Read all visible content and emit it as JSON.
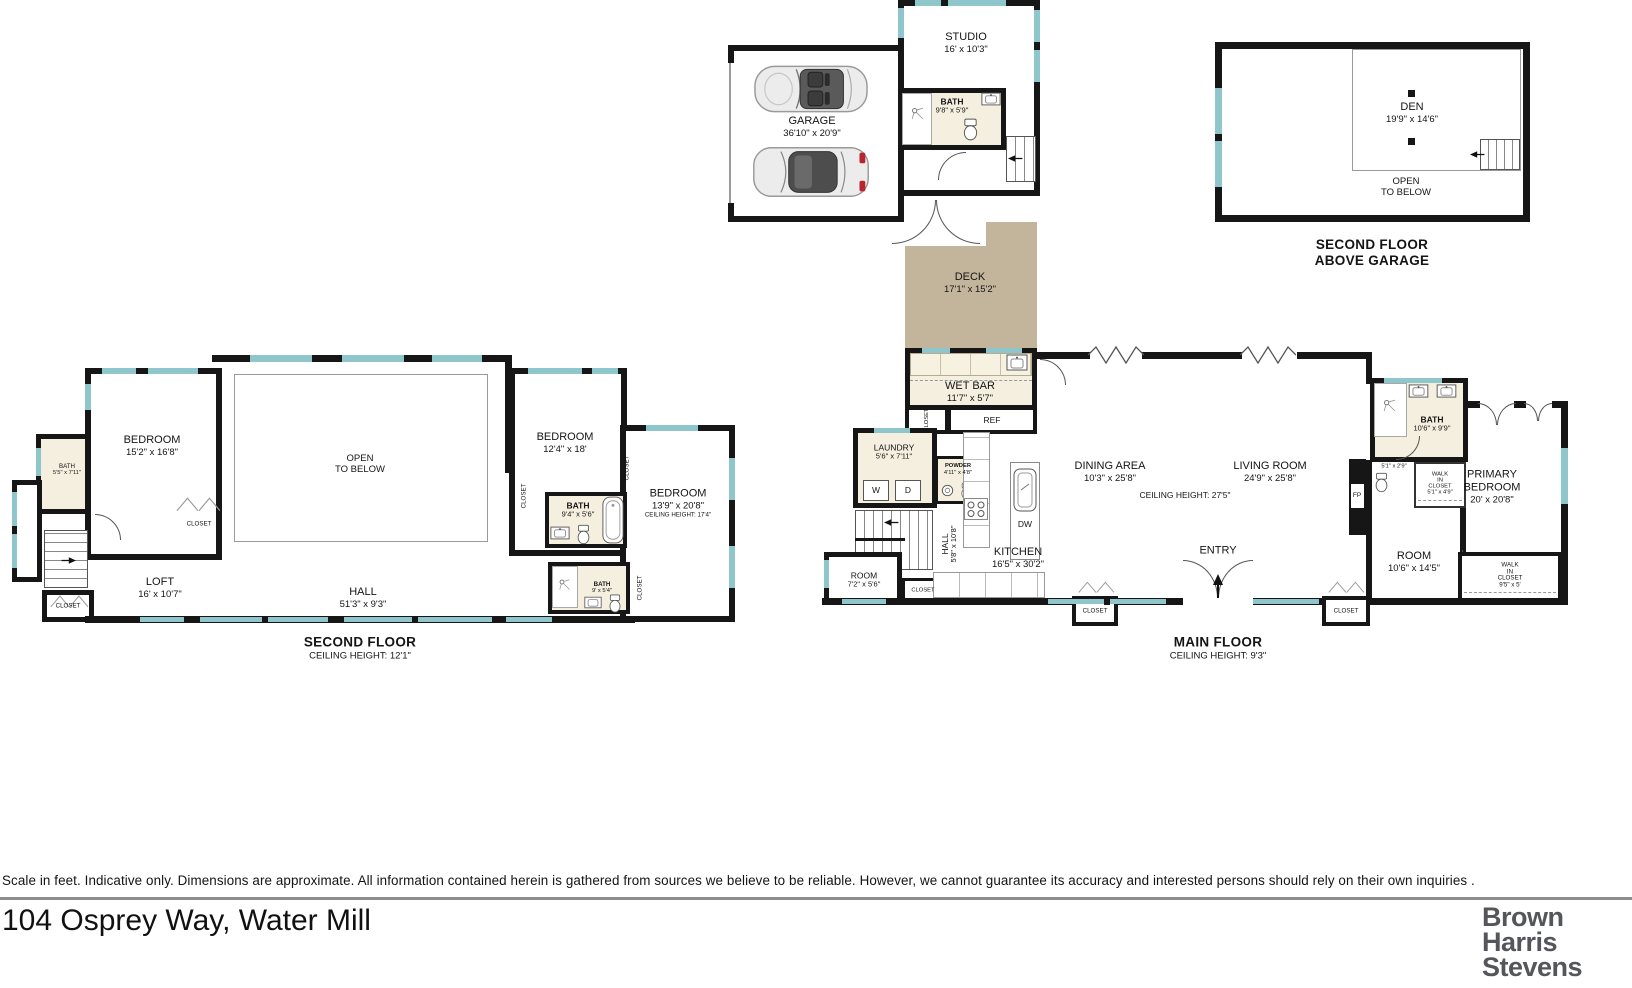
{
  "page": {
    "disclaimer": "Scale in feet. Indicative only. Dimensions are approximate. All information contained herein is gathered from sources we believe to be reliable. However, we cannot guarantee its accuracy and interested persons should rely on their own inquiries .",
    "address": "104 Osprey Way, Water Mill",
    "brand": {
      "line1": "Brown",
      "line2": "Harris",
      "line3": "Stevens"
    }
  },
  "colors": {
    "wall": "#161616",
    "window": "#8fc6cc",
    "deck": "#c3b59b",
    "bath_floor": "#f5efdf",
    "logo_gray": "#55565a"
  },
  "labels": {
    "closet": "CLOSET",
    "ref": "REF",
    "washer": "W",
    "dryer": "D",
    "dw": "DW",
    "fp": "FP",
    "entry": "ENTRY"
  },
  "garage_plan": {
    "garage": {
      "name": "GARAGE",
      "dims": "36'10\" x 20'9\""
    },
    "studio": {
      "name": "STUDIO",
      "dims": "16' x 10'3\""
    },
    "bath": {
      "name": "BATH",
      "dims": "9'8\" x 5'9\""
    }
  },
  "above_garage_plan": {
    "den": {
      "name": "DEN",
      "dims": "19'9\" x 14'6\""
    },
    "open": {
      "line1": "OPEN",
      "line2": "TO BELOW"
    },
    "title": {
      "line1": "SECOND FLOOR",
      "line2": "ABOVE GARAGE"
    }
  },
  "second_floor_plan": {
    "bedroom1": {
      "name": "BEDROOM",
      "dims": "15'2\" x 16'8\""
    },
    "bath1": {
      "name": "BATH",
      "dims": "5'5\" x 7'11\""
    },
    "open": {
      "line1": "OPEN",
      "line2": "TO BELOW"
    },
    "bedroom2": {
      "name": "BEDROOM",
      "dims": "12'4\" x 18'"
    },
    "bath2": {
      "name": "BATH",
      "dims": "9'4\" x 5'6\""
    },
    "bedroom3": {
      "name": "BEDROOM",
      "dims": "13'9\" x 20'8\"",
      "note": "CEILING HEIGHT: 17'4\""
    },
    "bath3": {
      "name": "BATH",
      "dims": "9' x 5'4\""
    },
    "loft": {
      "name": "LOFT",
      "dims": "16' x 10'7\""
    },
    "hall": {
      "name": "HALL",
      "dims": "51'3\" x 9'3\""
    },
    "title": "SECOND FLOOR",
    "subtitle": "CEILING HEIGHT: 12'1\""
  },
  "main_floor_plan": {
    "deck": {
      "name": "DECK",
      "dims": "17'1\" x 15'2\""
    },
    "wetbar": {
      "name": "WET BAR",
      "dims": "11'7\" x 5'7\""
    },
    "laundry": {
      "name": "LAUNDRY",
      "dims": "5'6\" x 7'11\""
    },
    "powder": {
      "name": "POWDER",
      "dims": "4'11\" x 4'8\""
    },
    "hall": {
      "name": "HALL",
      "dims": "5'8\" x 10'8\""
    },
    "room_small": {
      "name": "ROOM",
      "dims": "7'2\" x 5'6\""
    },
    "kitchen": {
      "name": "KITCHEN",
      "dims": "16'5\" x 30'2\""
    },
    "dining": {
      "name": "DINING AREA",
      "dims": "10'3\" x 25'8\""
    },
    "living": {
      "name": "LIVING ROOM",
      "dims": "24'9\" x 25'8\""
    },
    "ceiling_note": "CEILING HEIGHT: 27'5\"",
    "bath": {
      "name": "BATH",
      "dims": "10'6\" x 9'9\""
    },
    "wc_dims": "5'1\" x 2'9\"",
    "wic1": {
      "line1": "WALK",
      "line2": "IN",
      "line3": "CLOSET",
      "dims": "5'1\" x 4'9\""
    },
    "room": {
      "name": "ROOM",
      "dims": "10'6\" x 14'5\""
    },
    "primary": {
      "line1": "PRIMARY",
      "line2": "BEDROOM",
      "dims": "20' x 20'8\""
    },
    "wic2": {
      "line1": "WALK",
      "line2": "IN",
      "line3": "CLOSET",
      "dims": "9'5\" x 5'"
    },
    "title": "MAIN FLOOR",
    "subtitle": "CEILING HEIGHT: 9'3\""
  }
}
